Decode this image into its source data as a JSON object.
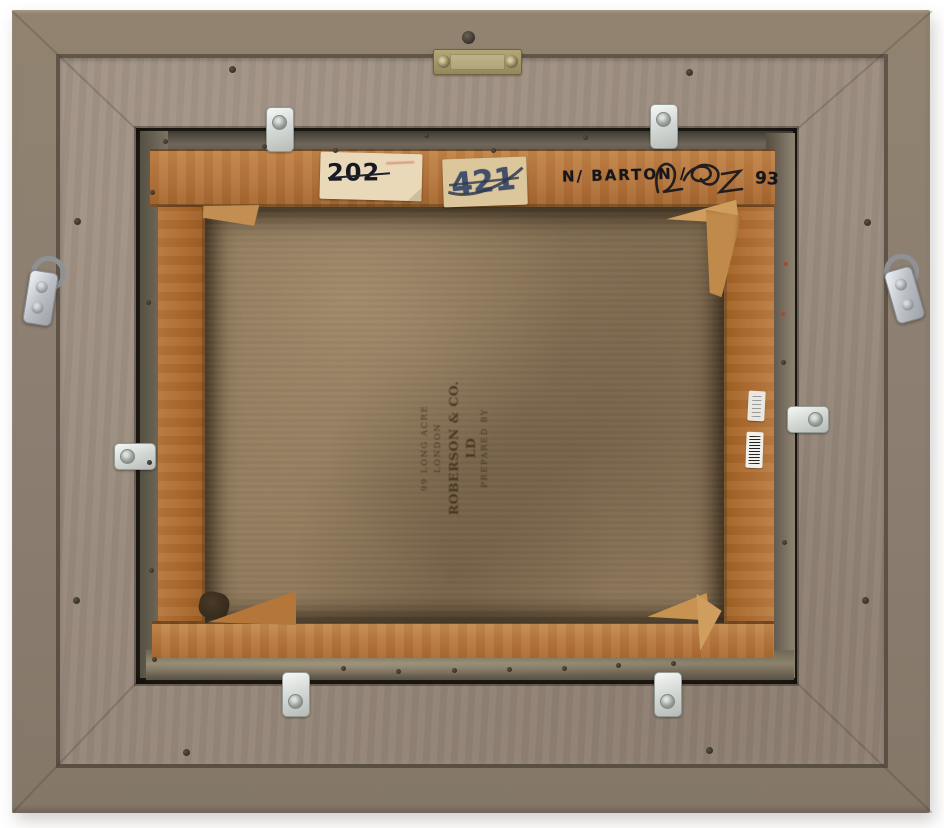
{
  "artwork_back": {
    "labels": {
      "stock_number": "202",
      "lot_number": "421"
    },
    "inscription": {
      "name": "N/ BARTON /",
      "year": "93"
    },
    "canvas_stamp": {
      "line1": "PREPARED BY",
      "line2": "ROBERSON & CO. LD",
      "line3": "99 LONG ACRE LONDON"
    },
    "colors": {
      "background": "#ffffff",
      "frame_outer_band": "#8b7e71",
      "frame_back_panel": "#9c8d7f",
      "stretcher_wood": "#b3743e",
      "canvas_fabric": "#8d775b",
      "tacking_edge": "#6e6557",
      "label_cream": "#e9d9b8",
      "label_tan": "#dcc69c",
      "ink_blue": "#42506c",
      "ink_black": "#15151a",
      "metal_silver": "#d9dcd9",
      "brass": "#a89a6a"
    }
  }
}
